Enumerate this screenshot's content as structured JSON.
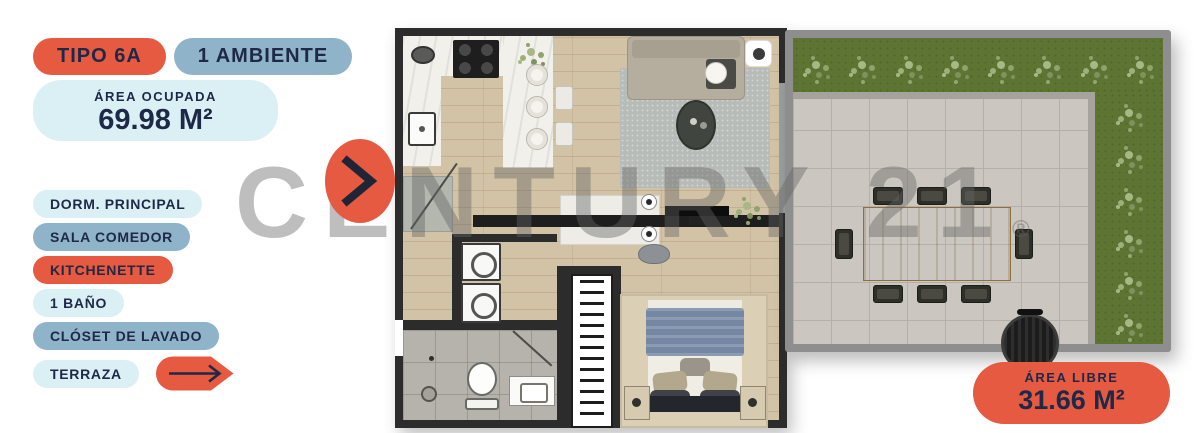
{
  "header": {
    "type_badge": "TIPO 6A",
    "ambiente_badge": "1 AMBIENTE",
    "area_ocupada_label": "ÁREA OCUPADA",
    "area_ocupada_value": "69.98 M²"
  },
  "rooms": [
    {
      "label": "DORM. PRINCIPAL"
    },
    {
      "label": "SALA COMEDOR"
    },
    {
      "label": "KITCHENETTE"
    },
    {
      "label": "1 BAÑO"
    },
    {
      "label": "CLÓSET DE LAVADO"
    },
    {
      "label": "TERRAZA"
    }
  ],
  "area_libre": {
    "label": "ÁREA LIBRE",
    "value": "31.66 M²"
  },
  "watermark": {
    "text": "CENTURY 21",
    "registered": "®"
  },
  "icons": {
    "next": "next-chevron-icon",
    "terraza_arrow": "right-arrow-icon"
  },
  "colors": {
    "orange": "#E55A41",
    "steel-blue": "#8FB3C9",
    "pale-cyan": "#DBF0F4",
    "navy": "#1E2847",
    "grass": "#5D7433",
    "tile": "#CBC7C0",
    "wood": "#D3C3A6",
    "marble": "#F1F0EB",
    "wall": "#2C2C2C",
    "terrace-border": "#8E8E8E"
  }
}
